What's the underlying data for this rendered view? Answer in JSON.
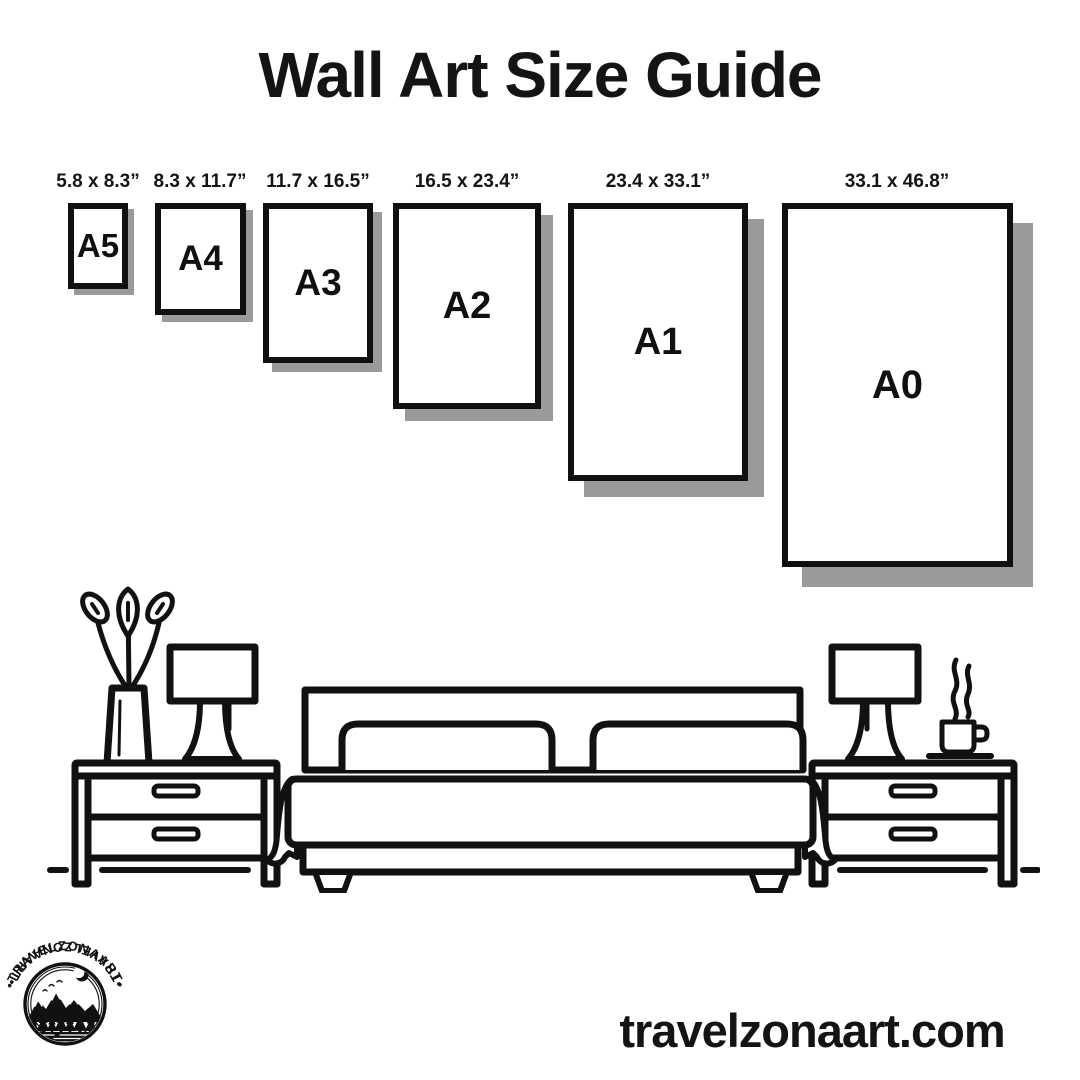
{
  "title": "Wall Art Size Guide",
  "sizes": [
    {
      "code": "A5",
      "dimensions": "5.8 x 8.3”"
    },
    {
      "code": "A4",
      "dimensions": "8.3 x 11.7”"
    },
    {
      "code": "A3",
      "dimensions": "11.7 x 16.5”"
    },
    {
      "code": "A2",
      "dimensions": "16.5 x 23.4”"
    },
    {
      "code": "A1",
      "dimensions": "23.4 x 33.1”"
    },
    {
      "code": "A0",
      "dimensions": "33.1 x 46.8”"
    }
  ],
  "scene": {
    "icons": [
      "plant-icon",
      "table-lamp-icon",
      "nightstand-icon",
      "bed-icon",
      "pillow-icon",
      "steam-icon",
      "coffee-cup-icon",
      "floor-line"
    ]
  },
  "logo": {
    "brand_top": "•TRAVELZONAART•",
    "brand_bottom": "•TRAVELZONAART•"
  },
  "footer": {
    "website": "travelzonaart.com"
  },
  "colors": {
    "ink": "#111111",
    "shadow": "#9a9a9a",
    "background": "#ffffff"
  }
}
